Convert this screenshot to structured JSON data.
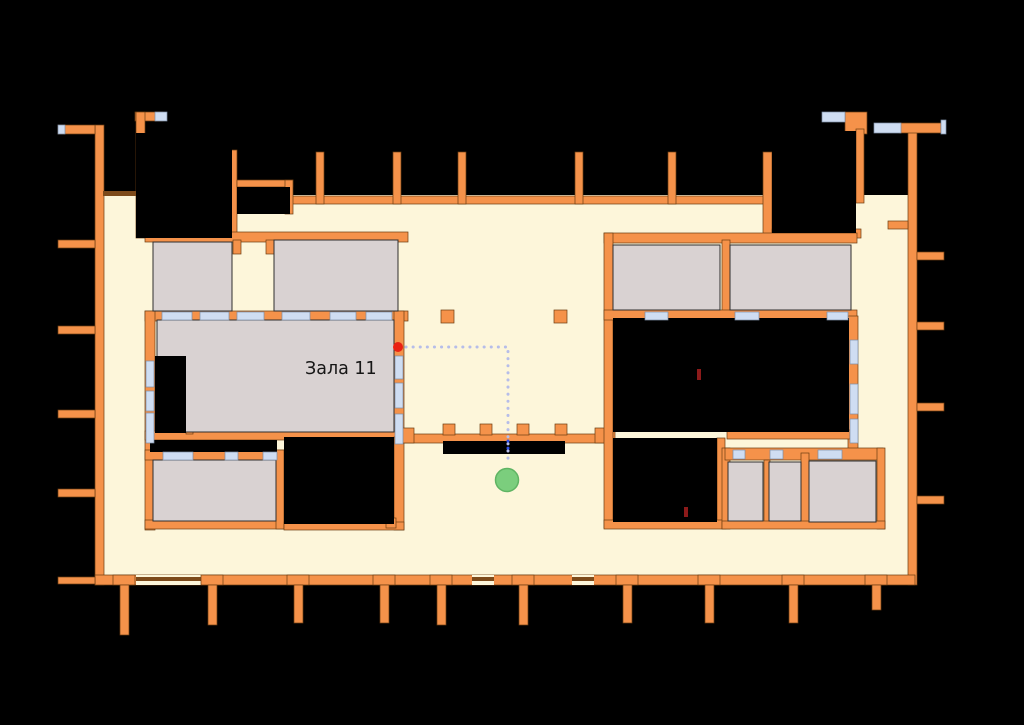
{
  "canvas": {
    "width": 1024,
    "height": 725
  },
  "map": {
    "type": "indoor floor plan (archaeological site navigation map)",
    "labels": {
      "hall11": "Зала 11"
    }
  },
  "markers": {
    "current_location": {
      "x": 507,
      "y": 480,
      "r": 11.5,
      "color": "#7bce7d",
      "border": "#5fb463"
    },
    "destination": {
      "x": 398,
      "y": 347,
      "r": 5,
      "color": "#ea2113"
    },
    "artifact_1": {
      "x": 697,
      "y": 369,
      "w": 4,
      "h": 11,
      "color": "#8c1a1a"
    },
    "artifact_2": {
      "x": 684,
      "y": 507,
      "w": 4,
      "h": 10,
      "color": "#8c1a1a"
    }
  },
  "route": {
    "d": "M 406 347 L 508 347 L 508 464",
    "highlight_d": "M 508 441 L 508 455",
    "color": "#b6bde9",
    "highlight_color": "#2e4ee6"
  },
  "colors": {
    "background": "#000000",
    "floor": "#fdf6da",
    "wall": "#f5924a",
    "wall_edge": "#6b3c10",
    "wall_dark": "#7d4a1a",
    "room": "#d9d2d2",
    "room_edge": "#2e2e2e",
    "window": "#cfddf2",
    "window_edge": "#7d8da6",
    "void": "#000000",
    "label": "#161616"
  }
}
